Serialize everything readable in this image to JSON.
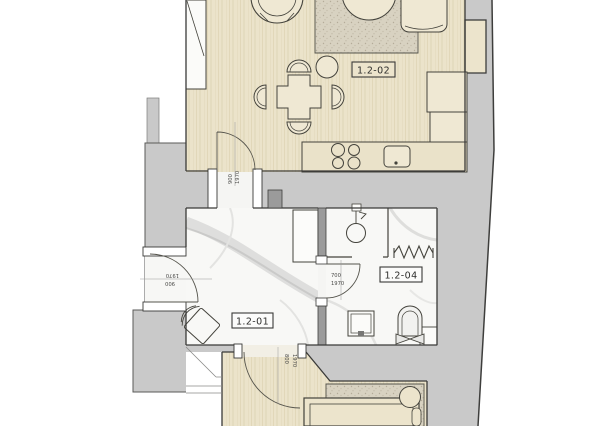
{
  "plan": {
    "type": "architectural-floor-plan",
    "rooms": [
      {
        "id": "living-kitchen",
        "label": "1.2-02"
      },
      {
        "id": "hallway",
        "label": "1.2-01"
      },
      {
        "id": "bathroom",
        "label": "1.2-04"
      }
    ],
    "doors": [
      {
        "id": "entrance-door",
        "width": "900",
        "height": "1970"
      },
      {
        "id": "living-door",
        "width": "900",
        "height": "1970"
      },
      {
        "id": "bathroom-door",
        "width": "700",
        "height": "1970"
      },
      {
        "id": "bedroom-door",
        "width": "800",
        "height": "1970"
      }
    ],
    "colors": {
      "wood_floor": "#ebe3ca",
      "wall_gray": "#c9c9c9",
      "wall_dark": "#9b9b9b",
      "marble": "#f8f8f7",
      "rug": "#d8d2c1",
      "outline": "#3a3a38"
    }
  }
}
